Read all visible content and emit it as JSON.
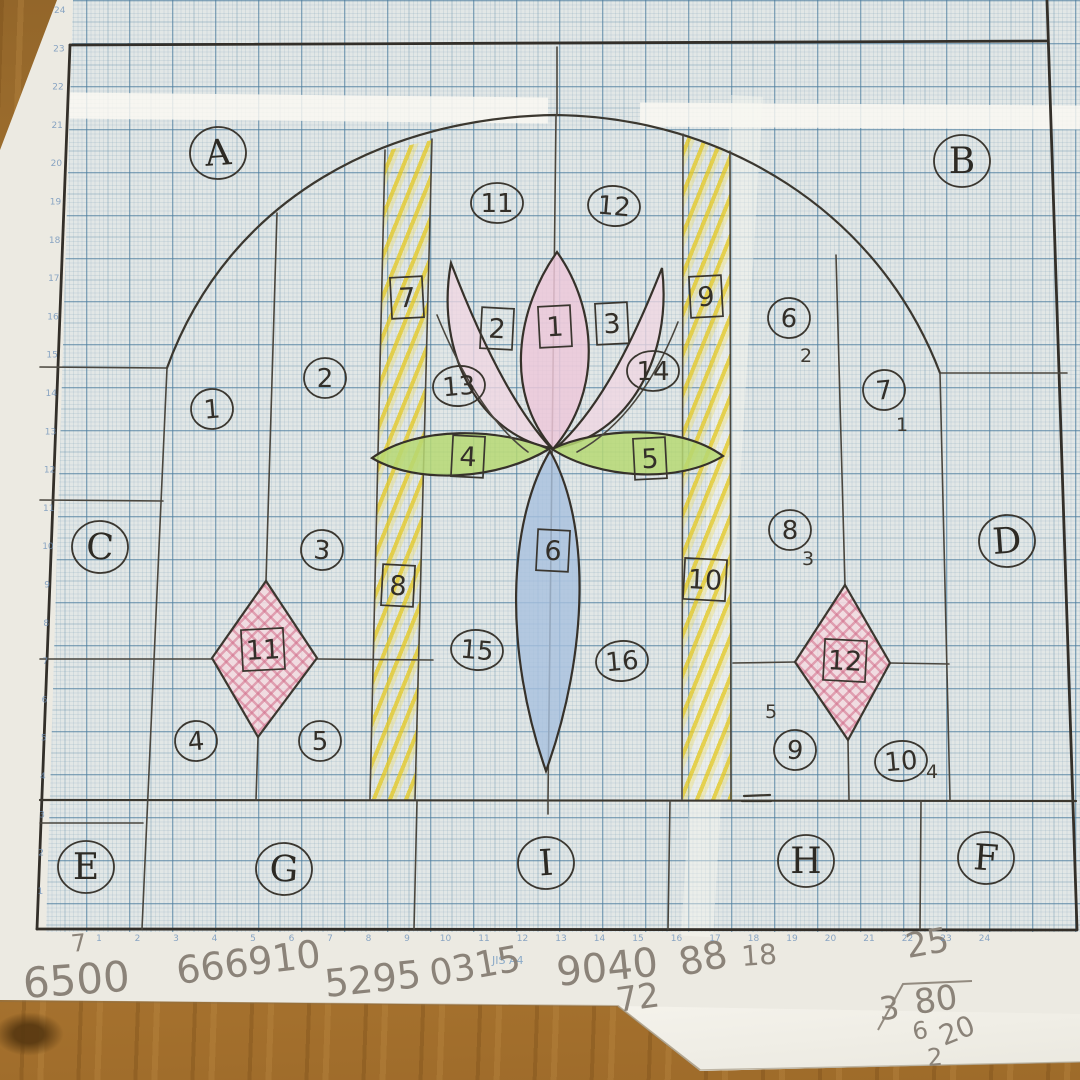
{
  "colors": {
    "pencil": "#3a362f",
    "grid_blue": "#7fa6bb",
    "hatch_yellow": "#e6cf45",
    "petal_pink": "#eecdde",
    "leaf_green": "#b6d873",
    "petal_blue": "#a7c1df",
    "diamond_pink": "#e4a9bb",
    "tape_white": "#f8f6ef",
    "wood_brown": "#aa7731",
    "paper": "#ecebe4"
  },
  "panel_labels": [
    {
      "text": "A",
      "x": 218,
      "y": 153
    },
    {
      "text": "B",
      "x": 962,
      "y": 161
    },
    {
      "text": "C",
      "x": 100,
      "y": 547
    },
    {
      "text": "D",
      "x": 1007,
      "y": 541
    },
    {
      "text": "E",
      "x": 86,
      "y": 867
    },
    {
      "text": "G",
      "x": 284,
      "y": 869
    },
    {
      "text": "I",
      "x": 546,
      "y": 863
    },
    {
      "text": "H",
      "x": 806,
      "y": 861
    },
    {
      "text": "F",
      "x": 986,
      "y": 858
    }
  ],
  "circled_numbers": [
    {
      "text": "1",
      "x": 212,
      "y": 409
    },
    {
      "text": "2",
      "x": 325,
      "y": 378
    },
    {
      "text": "3",
      "x": 322,
      "y": 550
    },
    {
      "text": "4",
      "x": 196,
      "y": 741
    },
    {
      "text": "5",
      "x": 320,
      "y": 741
    },
    {
      "text": "6",
      "x": 789,
      "y": 318
    },
    {
      "text": "7",
      "x": 884,
      "y": 390
    },
    {
      "text": "8",
      "x": 790,
      "y": 530
    },
    {
      "text": "9",
      "x": 795,
      "y": 750
    },
    {
      "text": "10",
      "x": 901,
      "y": 761
    },
    {
      "text": "11",
      "x": 497,
      "y": 203
    },
    {
      "text": "12",
      "x": 614,
      "y": 206
    },
    {
      "text": "13",
      "x": 459,
      "y": 386
    },
    {
      "text": "14",
      "x": 653,
      "y": 371
    },
    {
      "text": "15",
      "x": 477,
      "y": 650
    },
    {
      "text": "16",
      "x": 622,
      "y": 661
    }
  ],
  "boxed_numbers": [
    {
      "text": "1",
      "x": 555,
      "y": 327
    },
    {
      "text": "2",
      "x": 497,
      "y": 329
    },
    {
      "text": "3",
      "x": 612,
      "y": 324
    },
    {
      "text": "4",
      "x": 468,
      "y": 457
    },
    {
      "text": "5",
      "x": 650,
      "y": 459
    },
    {
      "text": "6",
      "x": 553,
      "y": 551
    },
    {
      "text": "7",
      "x": 407,
      "y": 298
    },
    {
      "text": "8",
      "x": 398,
      "y": 586
    },
    {
      "text": "9",
      "x": 706,
      "y": 297
    },
    {
      "text": "10",
      "x": 705,
      "y": 580
    },
    {
      "text": "11",
      "x": 263,
      "y": 650
    },
    {
      "text": "12",
      "x": 845,
      "y": 661
    }
  ],
  "small_notes": [
    {
      "text": "2",
      "x": 806,
      "y": 362
    },
    {
      "text": "1",
      "x": 902,
      "y": 431
    },
    {
      "text": "3",
      "x": 808,
      "y": 565
    },
    {
      "text": "5",
      "x": 771,
      "y": 718
    },
    {
      "text": "4",
      "x": 932,
      "y": 778
    }
  ],
  "calculations": [
    {
      "text": "7",
      "x": 72,
      "y": 952,
      "size": 24,
      "rot": -6
    },
    {
      "text": "6500",
      "x": 24,
      "y": 998,
      "size": 42,
      "rot": -4
    },
    {
      "text": "666910",
      "x": 178,
      "y": 984,
      "size": 38,
      "rot": -7
    },
    {
      "text": "5295",
      "x": 326,
      "y": 997,
      "size": 38,
      "rot": -6
    },
    {
      "text": "0315",
      "x": 432,
      "y": 986,
      "size": 36,
      "rot": -10
    },
    {
      "text": "9040",
      "x": 558,
      "y": 986,
      "size": 40,
      "rot": -6
    },
    {
      "text": "88",
      "x": 682,
      "y": 976,
      "size": 38,
      "rot": -12
    },
    {
      "text": "72",
      "x": 618,
      "y": 1012,
      "size": 34,
      "rot": -8
    },
    {
      "text": "18",
      "x": 742,
      "y": 966,
      "size": 28,
      "rot": -4
    },
    {
      "text": "25",
      "x": 908,
      "y": 958,
      "size": 34,
      "rot": -10
    },
    {
      "text": "3",
      "x": 880,
      "y": 1020,
      "size": 32,
      "rot": -5
    },
    {
      "text": "80",
      "x": 916,
      "y": 1014,
      "size": 34,
      "rot": -8
    },
    {
      "text": "6",
      "x": 914,
      "y": 1040,
      "size": 24,
      "rot": -10
    },
    {
      "text": "20",
      "x": 944,
      "y": 1046,
      "size": 28,
      "rot": -22
    },
    {
      "text": "2",
      "x": 928,
      "y": 1066,
      "size": 24,
      "rot": -5
    }
  ],
  "printed_label": {
    "text": "JIS A4"
  },
  "left_margin_numbers": [
    "24",
    "23",
    "22",
    "21",
    "20",
    "19",
    "18",
    "17",
    "16",
    "15",
    "14",
    "13",
    "12",
    "11",
    "10",
    "9",
    "8",
    "7",
    "6",
    "5",
    "4",
    "3",
    "2",
    "1"
  ],
  "bottom_margin_numbers": [
    "1",
    "2",
    "3",
    "4",
    "5",
    "6",
    "7",
    "8",
    "9",
    "10",
    "11",
    "12",
    "13",
    "14",
    "15",
    "16",
    "17",
    "18",
    "19",
    "20",
    "21",
    "22",
    "23",
    "24"
  ]
}
